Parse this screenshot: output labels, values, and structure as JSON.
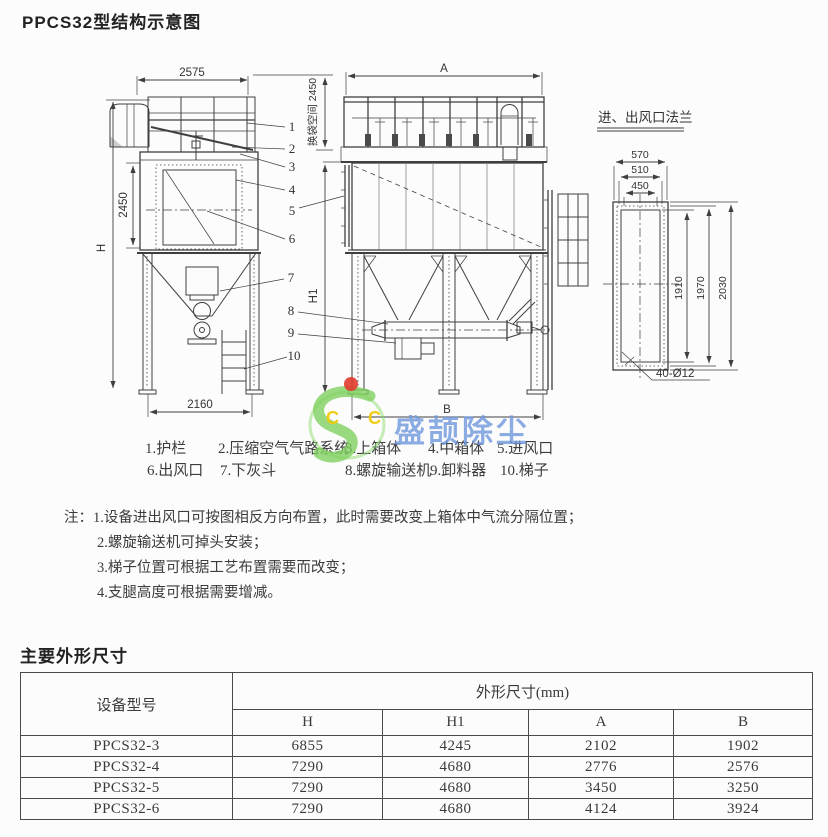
{
  "page": {
    "title": "PPCS32型结构示意图"
  },
  "drawing": {
    "left_view": {
      "dim_top_width": "2575",
      "dim_height_total": "H",
      "dim_body_height": "2450",
      "dim_bottom_width": "2160"
    },
    "front_view": {
      "dim_width": "A",
      "dim_bottom_width": "B",
      "dim_height": "H1",
      "dim_bag_space": "换袋空间 2450"
    },
    "flange_view": {
      "title": "进、出风口法兰",
      "dim_outer_width": "570",
      "dim_bolt_width": "510",
      "dim_inner_width": "450",
      "dim_inner_height": "1910",
      "dim_bolt_height": "1970",
      "dim_outer_height": "2030",
      "dim_bolt_holes": "40-Ø12"
    },
    "callout_numbers": [
      "1",
      "2",
      "3",
      "4",
      "5",
      "6",
      "7",
      "8",
      "9",
      "10"
    ]
  },
  "watermark": {
    "logo_letters": "C C",
    "brand_text": "盛颉除尘"
  },
  "legend": {
    "items": [
      "1.护栏",
      "2.压缩空气气路系统",
      "3.上箱体",
      "4.中箱体",
      "5.进风口",
      "6.出风口",
      "7.下灰斗",
      "8.螺旋输送机",
      "9.卸料器",
      "10.梯子"
    ]
  },
  "notes": {
    "prefix": "注：",
    "items": [
      "1.设备进出风口可按图相反方向布置，此时需要改变上箱体中气流分隔位置；",
      "2.螺旋输送机可掉头安装；",
      "3.梯子位置可根据工艺布置需要而改变；",
      "4.支腿高度可根据需要增减。"
    ]
  },
  "dimensions_section": {
    "title": "主要外形尺寸",
    "table": {
      "model_header": "设备型号",
      "group_header": "外形尺寸(mm)",
      "columns": [
        "H",
        "H1",
        "A",
        "B"
      ],
      "rows": [
        {
          "model": "PPCS32-3",
          "values": [
            "6855",
            "4245",
            "2102",
            "1902"
          ]
        },
        {
          "model": "PPCS32-4",
          "values": [
            "7290",
            "4680",
            "2776",
            "2576"
          ]
        },
        {
          "model": "PPCS32-5",
          "values": [
            "7290",
            "4680",
            "3450",
            "3250"
          ]
        },
        {
          "model": "PPCS32-6",
          "values": [
            "7290",
            "4680",
            "4124",
            "3924"
          ]
        }
      ]
    }
  }
}
